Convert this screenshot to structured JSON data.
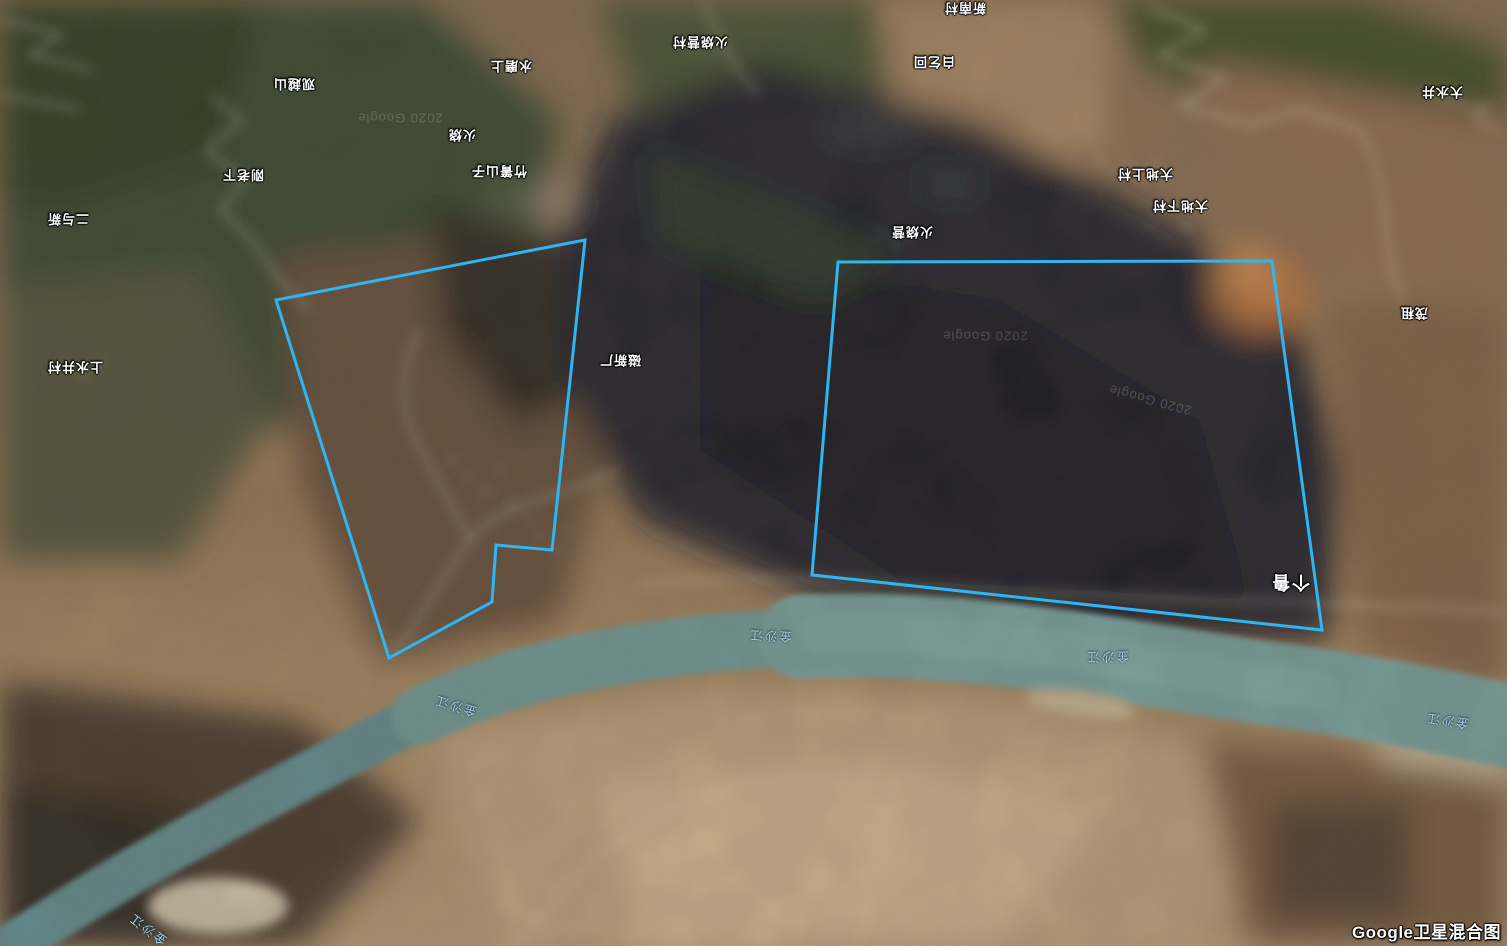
{
  "map": {
    "attribution": "Google卫星混合图",
    "labels": [
      {
        "name": "place-label-huoshaoyingcun",
        "text": "火烧营村",
        "x": 700,
        "y": 43,
        "kind": "place",
        "rot": 180
      },
      {
        "name": "place-label-xinnancun",
        "text": "新南村",
        "x": 965,
        "y": 9,
        "kind": "place",
        "rot": 180
      },
      {
        "name": "place-label-baiqihui",
        "text": "白乞回",
        "x": 934,
        "y": 63,
        "kind": "place",
        "rot": 180
      },
      {
        "name": "place-label-guanyueshan",
        "text": "观越山",
        "x": 294,
        "y": 85,
        "kind": "place",
        "rot": 180
      },
      {
        "name": "place-label-ganglaoxia",
        "text": "刚老下",
        "x": 243,
        "y": 176,
        "kind": "place",
        "rot": 180
      },
      {
        "name": "place-label-eryuxin",
        "text": "二与新",
        "x": 68,
        "y": 220,
        "kind": "place",
        "rot": 180
      },
      {
        "name": "place-label-shangshuijingcun",
        "text": "上水井村",
        "x": 75,
        "y": 368,
        "kind": "place",
        "rot": 180
      },
      {
        "name": "place-label-shuimoshang",
        "text": "水磨上",
        "x": 511,
        "y": 67,
        "kind": "place",
        "rot": 180
      },
      {
        "name": "place-label-huoshao",
        "text": "火烧",
        "x": 462,
        "y": 136,
        "kind": "place",
        "rot": 180
      },
      {
        "name": "place-label-zhuqingshanzi",
        "text": "竹箐山子",
        "x": 499,
        "y": 172,
        "kind": "place",
        "rot": 180
      },
      {
        "name": "place-label-cixinchang",
        "text": "磁新厂",
        "x": 620,
        "y": 361,
        "kind": "place",
        "rot": 180
      },
      {
        "name": "place-label-huoshaoying",
        "text": "火烧营",
        "x": 912,
        "y": 233,
        "kind": "place",
        "rot": 180
      },
      {
        "name": "place-label-dadishangcun",
        "text": "大地上村",
        "x": 1145,
        "y": 175,
        "kind": "place",
        "rot": 180
      },
      {
        "name": "place-label-dadixiacun",
        "text": "大地下村",
        "x": 1180,
        "y": 207,
        "kind": "place",
        "rot": 180
      },
      {
        "name": "place-label-dashuijing",
        "text": "大水井",
        "x": 1442,
        "y": 93,
        "kind": "place",
        "rot": 180
      },
      {
        "name": "place-label-maozu",
        "text": "茂租",
        "x": 1414,
        "y": 314,
        "kind": "place",
        "rot": 180
      },
      {
        "name": "place-label-gelu",
        "text": "个鲁",
        "x": 1290,
        "y": 583,
        "kind": "place",
        "rot": 180,
        "big": true
      },
      {
        "name": "water-label-jinshajiang-1",
        "text": "金沙江",
        "x": 770,
        "y": 637,
        "kind": "water",
        "rot": 183
      },
      {
        "name": "water-label-jinshajiang-2",
        "text": "金沙江",
        "x": 1107,
        "y": 658,
        "kind": "water",
        "rot": 180
      },
      {
        "name": "water-label-jinshajiang-3",
        "text": "金沙江",
        "x": 455,
        "y": 707,
        "kind": "water",
        "rot": 197
      },
      {
        "name": "water-label-jinshajiang-4",
        "text": "金沙江",
        "x": 147,
        "y": 930,
        "kind": "water",
        "rot": 217
      },
      {
        "name": "water-label-jinshajiang-5",
        "text": "金沙江",
        "x": 1447,
        "y": 722,
        "kind": "water",
        "rot": 188
      },
      {
        "name": "google-watermark-1",
        "text": "2020 Google",
        "x": 985,
        "y": 336,
        "kind": "wm",
        "rot": 180
      },
      {
        "name": "google-watermark-2",
        "text": "2020 Google",
        "x": 400,
        "y": 118,
        "kind": "wm",
        "rot": 180
      },
      {
        "name": "google-watermark-3",
        "text": "2020 Google",
        "x": 1150,
        "y": 400,
        "kind": "wm",
        "rot": 195
      }
    ],
    "annotation_color": "#2eb5f2",
    "polygons": [
      {
        "name": "survey-area-west",
        "points": [
          [
            585,
            240
          ],
          [
            276,
            300
          ],
          [
            389,
            658
          ],
          [
            492,
            602
          ],
          [
            496,
            545
          ],
          [
            552,
            550
          ]
        ]
      },
      {
        "name": "survey-area-east",
        "points": [
          [
            838,
            262
          ],
          [
            1272,
            261
          ],
          [
            1322,
            630
          ],
          [
            812,
            575
          ]
        ]
      }
    ]
  }
}
